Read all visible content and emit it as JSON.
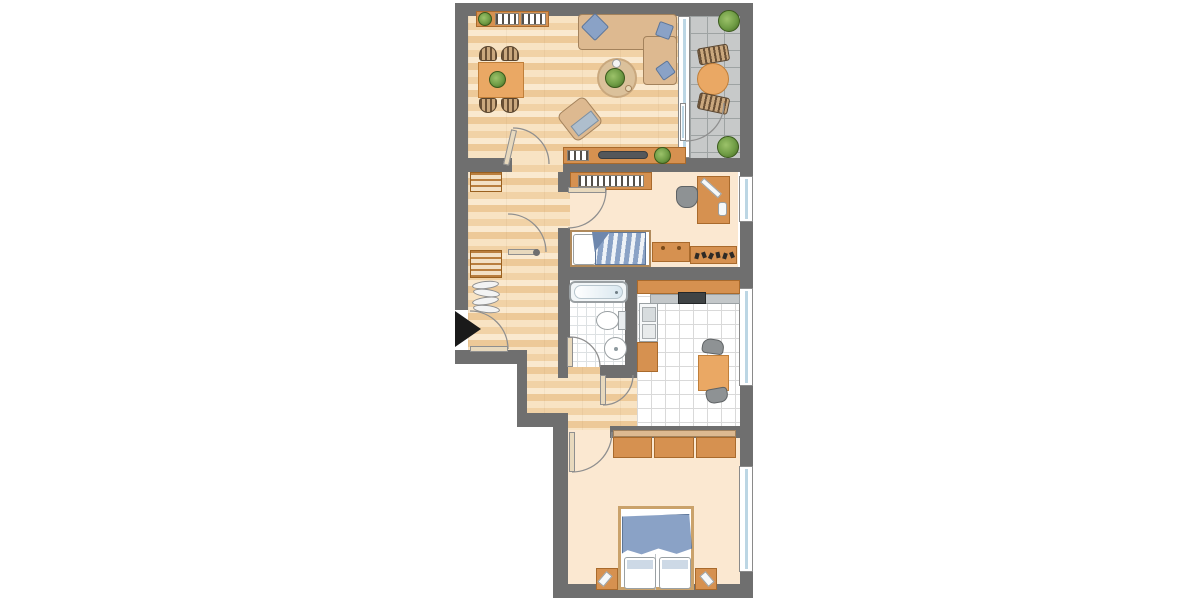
{
  "meta": {
    "title": "Apartment floor plan (top-down architectural drawing)",
    "diagram_type": "floor-plan",
    "visible_text": "none"
  },
  "palette": {
    "wall": "#6f6f6f",
    "wood_floor": "#f1d2a6",
    "plain_floor": "#fbe8d1",
    "tile_floor": "#ffffff",
    "balcony_floor": "#c7c9c9",
    "cabinet_orange": "#d69150",
    "upholstery_tan": "#ddb990",
    "textile_blue": "#8aa2c6",
    "appliance_white": "#f6f8f9",
    "tv_dark": "#54575a",
    "plant_green": "#6f9c45",
    "entrance_marker": "#1a1a1a",
    "glass": "#bcd6e4"
  },
  "rooms": [
    {
      "id": "living-room",
      "floor": "wood-planks",
      "furniture": [
        "wall-shelf-with-plant-and-books",
        "dining-table-with-plant",
        "dining-chair x4",
        "corner-sofa",
        "blue-cushion x3",
        "round-rug",
        "coffee-table-with-plant",
        "armchair",
        "tv-sideboard",
        "tv",
        "potted-plant"
      ]
    },
    {
      "id": "balcony",
      "floor": "stone-tiles",
      "furniture": [
        "round-table",
        "striped-chair x2",
        "potted-plant x2"
      ],
      "access": "glass-door-from-living-room"
    },
    {
      "id": "hallway",
      "floor": "wood-planks",
      "furniture": [
        "slatted-shelf-unit x2",
        "coat-rack-with-hangers"
      ]
    },
    {
      "id": "kids-room",
      "floor": "plain",
      "furniture": [
        "bookshelf",
        "desk",
        "desk-chair",
        "desk-lamp",
        "single-bed-striped-duvet",
        "dresser",
        "toy-shelf"
      ]
    },
    {
      "id": "bathroom",
      "floor": "small-white-tiles",
      "furniture": [
        "bathtub",
        "toilet",
        "washbasin"
      ]
    },
    {
      "id": "kitchen",
      "floor": "white-tiles",
      "furniture": [
        "upper-counter-run",
        "stove",
        "sink-unit",
        "base-cabinet",
        "square-table",
        "chair x2"
      ]
    },
    {
      "id": "bedroom",
      "floor": "plain",
      "furniture": [
        "three-door-wardrobe",
        "double-bed",
        "pillow x2",
        "blue-blanket",
        "nightstand-with-lamp x2"
      ]
    }
  ],
  "doors": [
    "entrance-door",
    "living-to-hall-door",
    "hall-middle-door",
    "kids-room-door",
    "bathroom-door",
    "kitchen-door",
    "bedroom-door",
    "balcony-glass-door"
  ],
  "windows": [
    "kids-room-window",
    "kitchen-window",
    "bedroom-window",
    "balcony-glazing"
  ],
  "entrance": {
    "marker": "solid-black-arrow",
    "points": "right",
    "location": "left-wall-of-hallway"
  }
}
